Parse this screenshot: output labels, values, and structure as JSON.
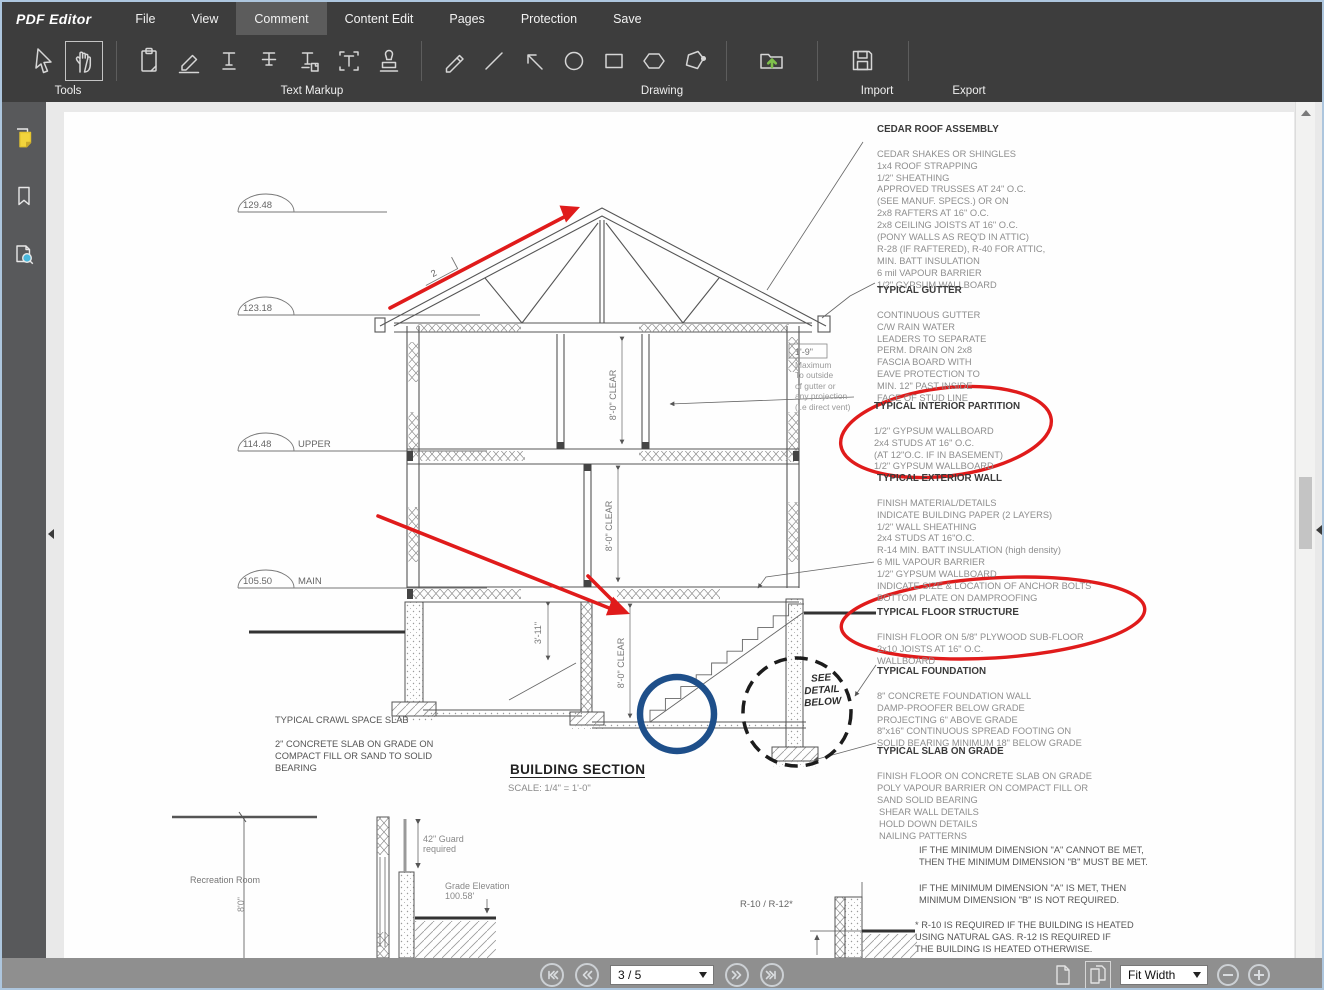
{
  "app": {
    "brand": "PDF Editor"
  },
  "menu": {
    "items": [
      "File",
      "View",
      "Comment",
      "Content Edit",
      "Pages",
      "Protection",
      "Save"
    ],
    "active": "Comment"
  },
  "toolbar": {
    "tools_label": "Tools",
    "text_markup_label": "Text Markup",
    "drawing_label": "Drawing",
    "import_label": "Import",
    "export_label": "Export",
    "icon_names": [
      "select-cursor",
      "hand-pan",
      "note",
      "highlighter",
      "text-underline",
      "text-strikeout",
      "text-insert",
      "text-box",
      "stamp",
      "pencil",
      "line",
      "arrow",
      "ellipse",
      "rectangle",
      "hexagon",
      "polygon",
      "import-folder",
      "export-disk"
    ]
  },
  "sidebar": {
    "icon_names": [
      "comment-note",
      "bookmark",
      "page-search"
    ]
  },
  "statusbar": {
    "page_indicator": "3 / 5",
    "zoom_mode": "Fit Width"
  },
  "colors": {
    "annotation_red": "#e01b1b",
    "annotation_blue": "#1e4f8a",
    "import_green": "#7ec04b",
    "note_yellow": "#f2d43c",
    "active_menu_bg": "#5c5c5c"
  },
  "document": {
    "elevations": [
      {
        "value": "129.48",
        "label": ""
      },
      {
        "value": "123.18",
        "label": ""
      },
      {
        "value": "114.48",
        "label": "UPPER"
      },
      {
        "value": "105.50",
        "label": "MAIN"
      }
    ],
    "dims": {
      "upper_clear": "8'-0\" CLEAR",
      "main_clear": "8'-0\" CLEAR",
      "stair_clear": "8'-0\" CLEAR",
      "basement_width": "3'-11\"",
      "rec_height": "8'0\""
    },
    "slope_label": "2",
    "gutter_dim": "1'-9\"",
    "gutter_note": "Maximum\nTo outside\nof gutter or\nany projection\n(i.e direct vent)",
    "see_detail": "SEE\nDETAIL\nBELOW",
    "spec_blocks": [
      {
        "title": "CEDAR ROOF ASSEMBLY",
        "body": "CEDAR SHAKES OR SHINGLES\n1x4 ROOF STRAPPING\n1/2\" SHEATHING\nAPPROVED TRUSSES AT 24\" O.C.\n(SEE MANUF. SPECS.) OR ON\n2x8 RAFTERS AT 16\" O.C.\n2x8 CEILING JOISTS AT 16\" O.C.\n(PONY WALLS AS REQ'D IN ATTIC)\nR-28 (IF RAFTERED), R-40 FOR ATTIC,\nMIN. BATT INSULATION\n6 mil VAPOUR BARRIER\n1/2\" GYPSUM WALLBOARD"
      },
      {
        "title": "TYPICAL GUTTER",
        "body": "CONTINUOUS GUTTER\nC/W RAIN WATER\nLEADERS TO SEPARATE\nPERM. DRAIN ON 2x8\nFASCIA BOARD WITH\nEAVE PROTECTION TO\nMIN. 12\" PAST INSIDE\nFACE OF STUD LINE"
      },
      {
        "title": "TYPICAL INTERIOR PARTITION",
        "body": "1/2\" GYPSUM WALLBOARD\n2x4 STUDS AT 16\" O.C.\n(AT 12\"O.C. IF IN BASEMENT)\n1/2\" GYPSUM WALLBOARD"
      },
      {
        "title": "TYPICAL EXTERIOR WALL",
        "body": "FINISH MATERIAL/DETAILS\nINDICATE BUILDING PAPER (2 LAYERS)\n1/2\" WALL SHEATHING\n2x4 STUDS AT 16\"O.C.\nR-14 MIN. BATT INSULATION (high density)\n6 MIL VAPOUR BARRIER\n1/2\" GYPSUM WALLBOARD\nINDICATE SIZE & LOCATION OF ANCHOR BOLTS\nBOTTOM PLATE ON DAMPROOFING"
      },
      {
        "title": "TYPICAL FLOOR STRUCTURE",
        "body": "FINISH FLOOR ON 5/8\" PLYWOOD SUB-FLOOR\n2x10 JOISTS AT 16\" O.C.\nWALLBOARD"
      },
      {
        "title": "TYPICAL FOUNDATION",
        "body": "8\" CONCRETE FOUNDATION WALL\nDAMP-PROOFER BELOW GRADE\nPROJECTING 6\" ABOVE GRADE\n8\"x16\" CONTINUOUS SPREAD FOOTING ON\nSOLID BEARING MINIMUM 18\" BELOW GRADE"
      },
      {
        "title": "TYPICAL SLAB ON GRADE",
        "body": "FINISH FLOOR ON CONCRETE SLAB ON GRADE\nPOLY VAPOUR BARRIER ON COMPACT FILL OR\nSAND SOLID BEARING"
      },
      {
        "title": "",
        "body": "SHEAR WALL DETAILS\nHOLD DOWN DETAILS\nNAILING PATTERNS"
      }
    ],
    "notes": [
      "IF THE MINIMUM DIMENSION \"A\" CANNOT BE MET,\nTHEN THE MINIMUM DIMENSION \"B\" MUST BE MET.",
      "IF THE MINIMUM DIMENSION \"A\" IS MET, THEN\nMINIMUM DIMENSION \"B\" IS NOT REQUIRED.",
      "* R-10 IS REQUIRED IF THE BUILDING IS HEATED\nUSING NATURAL GAS. R-12 IS REQUIRED IF\nTHE BUILDING IS HEATED OTHERWISE."
    ],
    "crawl_note": {
      "title": "TYPICAL CRAWL SPACE SLAB",
      "body": "2\" CONCRETE SLAB ON GRADE ON\nCOMPACT FILL OR SAND  TO SOLID\nBEARING"
    },
    "detail_labels": {
      "recreation": "Recreation Room",
      "guard": "42\" Guard\nrequired",
      "grade": "Grade Elevation\n100.58'",
      "r_value": "R-10 / R-12*"
    },
    "title_block": {
      "title": "BUILDING SECTION",
      "scale": "SCALE: 1/4\" = 1'-0\""
    }
  }
}
